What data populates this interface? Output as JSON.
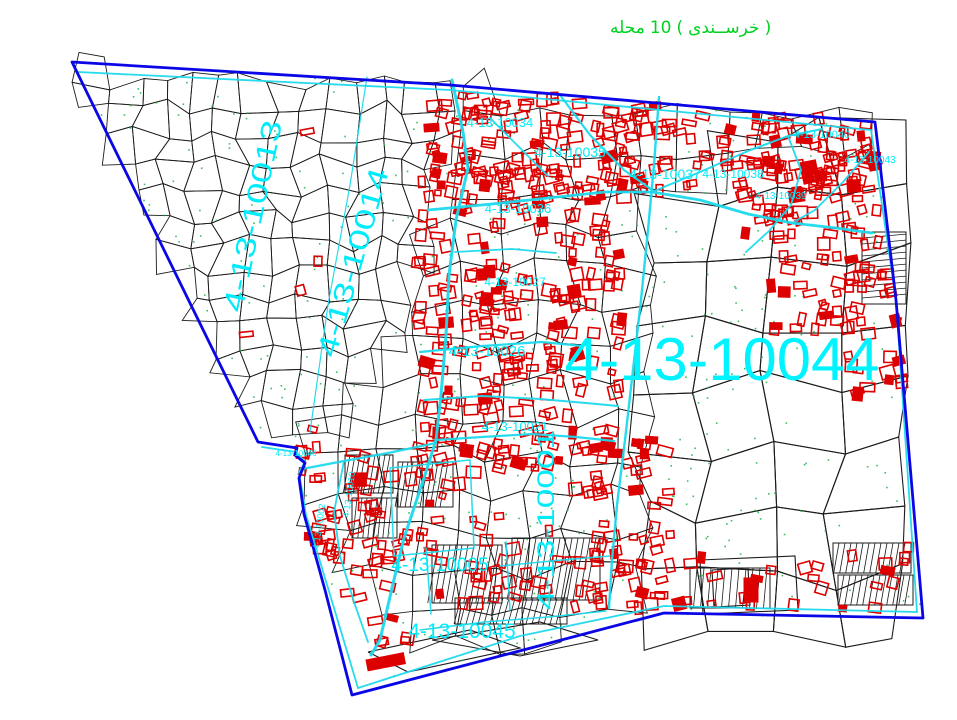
{
  "title": {
    "text": "محله 10 ( خرســندی )",
    "parts": [
      "محله",
      "10",
      "(",
      "خرســندی",
      ")"
    ],
    "color": "#00d221"
  },
  "map": {
    "seed": 7,
    "background": "#ffffff",
    "colors": {
      "boundary": "#0a06e6",
      "road": "#1bd9ec",
      "label": "#00ecfb",
      "big_label": "#00f4ff",
      "parcel": "#1c1c1c",
      "building": "#dd0000",
      "dot": "#1ab34a"
    },
    "boundary": [
      [
        72,
        62
      ],
      [
        450,
        85
      ],
      [
        875,
        122
      ],
      [
        896,
        300
      ],
      [
        923,
        618
      ],
      [
        664,
        613
      ],
      [
        352,
        695
      ],
      [
        325,
        590
      ],
      [
        304,
        514
      ],
      [
        299,
        478
      ],
      [
        305,
        463
      ],
      [
        295,
        455
      ],
      [
        297,
        448
      ],
      [
        258,
        442
      ]
    ],
    "fabric_zones": [
      {
        "name": "northwest-organic",
        "spacing": 27,
        "jitter": 9,
        "stroke_w": 0.9,
        "poly": [
          [
            78,
            68
          ],
          [
            455,
            88
          ],
          [
            440,
            200
          ],
          [
            400,
            335
          ],
          [
            335,
            432
          ],
          [
            264,
            442
          ]
        ]
      },
      {
        "name": "east-large-parcels",
        "spacing": 64,
        "jitter": 15,
        "stroke_w": 1.1,
        "poly": [
          [
            655,
            192
          ],
          [
            876,
            126
          ],
          [
            920,
            614
          ],
          [
            660,
            610
          ]
        ]
      },
      {
        "name": "central-mixed",
        "spacing": 38,
        "jitter": 11,
        "stroke_w": 0.9,
        "poly": [
          [
            430,
            86
          ],
          [
            875,
            122
          ],
          [
            920,
            612
          ],
          [
            664,
            610
          ],
          [
            424,
            652
          ],
          [
            332,
            562
          ],
          [
            300,
            470
          ],
          [
            302,
            432
          ],
          [
            400,
            332
          ],
          [
            442,
            200
          ]
        ],
        "exclude": [
          0,
          1
        ]
      }
    ],
    "extra_black_polys": [
      [
        [
          368,
          652
        ],
        [
          470,
          630
        ],
        [
          520,
          648
        ],
        [
          408,
          672
        ],
        [
          368,
          652
        ]
      ],
      [
        [
          432,
          640
        ],
        [
          540,
          622
        ],
        [
          598,
          640
        ],
        [
          520,
          656
        ],
        [
          432,
          640
        ]
      ],
      [
        [
          700,
          560
        ],
        [
          795,
          556
        ],
        [
          798,
          610
        ],
        [
          703,
          614
        ],
        [
          700,
          560
        ]
      ],
      [
        [
          712,
          570
        ],
        [
          748,
          568
        ],
        [
          750,
          605
        ],
        [
          714,
          607
        ],
        [
          712,
          570
        ]
      ]
    ],
    "hatch_blocks": [
      {
        "x": 345,
        "y": 455,
        "w": 48,
        "h": 38,
        "angle": 100,
        "step": 5
      },
      {
        "x": 352,
        "y": 498,
        "w": 45,
        "h": 40,
        "angle": 96,
        "step": 5
      },
      {
        "x": 398,
        "y": 462,
        "w": 55,
        "h": 45,
        "angle": 100,
        "step": 5
      },
      {
        "x": 432,
        "y": 545,
        "w": 70,
        "h": 58,
        "angle": 100,
        "step": 6
      },
      {
        "x": 512,
        "y": 538,
        "w": 88,
        "h": 62,
        "angle": 100,
        "step": 6
      },
      {
        "x": 455,
        "y": 598,
        "w": 112,
        "h": 26,
        "angle": 105,
        "step": 6
      },
      {
        "x": 862,
        "y": 232,
        "w": 44,
        "h": 72,
        "angle": 5,
        "step": 6
      },
      {
        "x": 833,
        "y": 543,
        "w": 78,
        "h": 30,
        "angle": 100,
        "step": 6
      },
      {
        "x": 838,
        "y": 575,
        "w": 75,
        "h": 30,
        "angle": 100,
        "step": 6
      },
      {
        "x": 690,
        "y": 568,
        "w": 80,
        "h": 40,
        "angle": 95,
        "step": 7
      }
    ],
    "roads": [
      {
        "w": 1.8,
        "pts": [
          [
            78,
            72
          ],
          [
            450,
            90
          ],
          [
            871,
            130
          ]
        ]
      },
      {
        "w": 1.8,
        "pts": [
          [
            871,
            130
          ],
          [
            896,
            300
          ],
          [
            917,
            612
          ]
        ]
      },
      {
        "w": 1.8,
        "pts": [
          [
            917,
            612
          ],
          [
            664,
            606
          ],
          [
            520,
            636
          ],
          [
            358,
            688
          ]
        ]
      },
      {
        "w": 1.8,
        "pts": [
          [
            358,
            688
          ],
          [
            328,
            588
          ],
          [
            306,
            515
          ],
          [
            299,
            472
          ],
          [
            305,
            462
          ],
          [
            296,
            452
          ],
          [
            262,
            447
          ]
        ]
      },
      {
        "w": 1.2,
        "pts": [
          [
            367,
            77
          ],
          [
            350,
            185
          ],
          [
            328,
            305
          ],
          [
            310,
            432
          ]
        ]
      },
      {
        "w": 3,
        "pts": [
          [
            452,
            80
          ],
          [
            463,
            132
          ],
          [
            468,
            168
          ],
          [
            456,
            220
          ],
          [
            449,
            275
          ],
          [
            446,
            335
          ],
          [
            441,
            395
          ],
          [
            436,
            440
          ],
          [
            424,
            478
          ],
          [
            404,
            538
          ],
          [
            392,
            588
          ],
          [
            380,
            640
          ],
          [
            371,
            655
          ]
        ]
      },
      {
        "w": 2.4,
        "pts": [
          [
            659,
            97
          ],
          [
            654,
            165
          ],
          [
            648,
            230
          ],
          [
            641,
            300
          ],
          [
            633,
            370
          ],
          [
            625,
            440
          ],
          [
            617,
            505
          ],
          [
            612,
            560
          ],
          [
            609,
            608
          ]
        ]
      },
      {
        "w": 2.8,
        "pts": [
          [
            428,
            210
          ],
          [
            492,
            204
          ],
          [
            548,
            198
          ],
          [
            605,
            192
          ],
          [
            652,
            192
          ],
          [
            700,
            200
          ],
          [
            748,
            214
          ],
          [
            792,
            223
          ],
          [
            836,
            228
          ],
          [
            872,
            233
          ]
        ]
      },
      {
        "w": 2.2,
        "pts": [
          [
            560,
            95
          ],
          [
            590,
            135
          ],
          [
            624,
            170
          ],
          [
            655,
            192
          ]
        ]
      },
      {
        "w": 2,
        "pts": [
          [
            652,
            192
          ],
          [
            700,
            172
          ],
          [
            748,
            151
          ],
          [
            788,
            136
          ],
          [
            822,
            129
          ]
        ]
      },
      {
        "w": 1.8,
        "pts": [
          [
            788,
            136
          ],
          [
            801,
            170
          ],
          [
            791,
            205
          ],
          [
            769,
            231
          ],
          [
            746,
            252
          ]
        ]
      },
      {
        "w": 1.8,
        "pts": [
          [
            869,
            152
          ],
          [
            843,
            182
          ],
          [
            815,
            210
          ],
          [
            792,
            223
          ]
        ]
      },
      {
        "w": 2.2,
        "pts": [
          [
            420,
            352
          ],
          [
            482,
            346
          ],
          [
            542,
            342
          ],
          [
            582,
            346
          ]
        ]
      },
      {
        "w": 2,
        "pts": [
          [
            424,
            400
          ],
          [
            482,
            396
          ],
          [
            540,
            399
          ],
          [
            586,
            403
          ],
          [
            618,
            406
          ]
        ]
      },
      {
        "w": 1.8,
        "pts": [
          [
            455,
            252
          ],
          [
            512,
            249
          ],
          [
            556,
            253
          ]
        ]
      },
      {
        "w": 2.2,
        "pts": [
          [
            436,
            440
          ],
          [
            482,
            437
          ],
          [
            532,
            434
          ],
          [
            576,
            437
          ],
          [
            614,
            441
          ]
        ]
      },
      {
        "w": 2.2,
        "pts": [
          [
            436,
            443
          ],
          [
            388,
            453
          ],
          [
            344,
            461
          ],
          [
            302,
            469
          ]
        ]
      },
      {
        "w": 1.8,
        "pts": [
          [
            344,
            461
          ],
          [
            334,
            512
          ],
          [
            340,
            556
          ],
          [
            354,
            602
          ],
          [
            368,
            642
          ]
        ]
      },
      {
        "w": 1.5,
        "pts": [
          [
            390,
            468
          ],
          [
            470,
            460
          ],
          [
            474,
            548
          ],
          [
            394,
            556
          ],
          [
            390,
            468
          ]
        ]
      },
      {
        "w": 1.5,
        "pts": [
          [
            426,
            548
          ],
          [
            431,
            614
          ]
        ]
      },
      {
        "w": 1.5,
        "pts": [
          [
            506,
            542
          ],
          [
            510,
            610
          ]
        ]
      },
      {
        "w": 1.5,
        "pts": [
          [
            500,
            566
          ],
          [
            562,
            560
          ],
          [
            610,
            556
          ]
        ]
      },
      {
        "w": 1.8,
        "pts": [
          [
            490,
            118
          ],
          [
            522,
            150
          ],
          [
            548,
            176
          ]
        ]
      },
      {
        "w": 1.5,
        "pts": [
          [
            420,
            630
          ],
          [
            485,
            622
          ],
          [
            548,
            617
          ],
          [
            606,
            611
          ]
        ]
      }
    ],
    "building_clusters": [
      {
        "x": 418,
        "y": 165,
        "w": 205,
        "h": 300,
        "count": 240
      },
      {
        "x": 430,
        "y": 95,
        "w": 320,
        "h": 105,
        "count": 150
      },
      {
        "x": 742,
        "y": 112,
        "w": 135,
        "h": 125,
        "count": 115
      },
      {
        "x": 765,
        "y": 235,
        "w": 140,
        "h": 95,
        "count": 50
      },
      {
        "x": 845,
        "y": 320,
        "w": 65,
        "h": 75,
        "count": 15
      },
      {
        "x": 298,
        "y": 428,
        "w": 135,
        "h": 175,
        "count": 70
      },
      {
        "x": 428,
        "y": 438,
        "w": 185,
        "h": 170,
        "count": 60
      },
      {
        "x": 596,
        "y": 440,
        "w": 75,
        "h": 175,
        "count": 45
      },
      {
        "x": 640,
        "y": 555,
        "w": 230,
        "h": 55,
        "count": 22
      },
      {
        "x": 105,
        "y": 95,
        "w": 260,
        "h": 270,
        "count": 7
      },
      {
        "x": 360,
        "y": 612,
        "w": 60,
        "h": 40,
        "count": 6
      },
      {
        "x": 868,
        "y": 545,
        "w": 50,
        "h": 70,
        "count": 8
      }
    ],
    "special_buildings": [
      {
        "x": 366,
        "y": 660,
        "w": 38,
        "h": 11,
        "rot": -11
      },
      {
        "x": 744,
        "y": 578,
        "w": 14,
        "h": 24,
        "rot": 0
      }
    ],
    "green_dots": 430,
    "district_labels": [
      {
        "text": "4-13-10013",
        "x": 262,
        "y": 218,
        "size": 28,
        "rot": -78,
        "len": 195
      },
      {
        "text": "4-13-10014",
        "x": 362,
        "y": 265,
        "size": 28,
        "rot": -74,
        "len": 195
      },
      {
        "text": "4-13-10044",
        "x": 722,
        "y": 380,
        "size": 60,
        "rot": 0,
        "len": 315
      },
      {
        "text": "4-13-10034",
        "x": 500,
        "y": 127,
        "size": 13,
        "rot": 0
      },
      {
        "text": "4-13-10035",
        "x": 570,
        "y": 157,
        "size": 14,
        "rot": 0
      },
      {
        "text": "4-13-10036",
        "x": 518,
        "y": 213,
        "size": 13,
        "rot": 0
      },
      {
        "text": "4-13-10037",
        "x": 665,
        "y": 179,
        "size": 14,
        "rot": 0
      },
      {
        "text": "4-13-10038",
        "x": 733,
        "y": 178,
        "size": 12,
        "rot": 0
      },
      {
        "text": "4-13-10039",
        "x": 781,
        "y": 199,
        "size": 10,
        "rot": 0
      },
      {
        "text": "4-13-10040",
        "x": 822,
        "y": 138,
        "size": 11,
        "rot": 0
      },
      {
        "text": "4-13-10043",
        "x": 870,
        "y": 163,
        "size": 10,
        "rot": 0
      },
      {
        "text": "4-13-10027",
        "x": 515,
        "y": 286,
        "size": 12,
        "rot": 0
      },
      {
        "text": "4-13-10026",
        "x": 487,
        "y": 356,
        "size": 15,
        "rot": 0
      },
      {
        "text": "4-13-10021",
        "x": 515,
        "y": 431,
        "size": 13,
        "rot": 0
      },
      {
        "text": "4-13-10001",
        "x": 554,
        "y": 520,
        "size": 24,
        "rot": -90,
        "len": 180
      },
      {
        "text": "4-13-10005",
        "x": 440,
        "y": 571,
        "size": 19,
        "rot": 0
      },
      {
        "text": "4-13-10045",
        "x": 462,
        "y": 638,
        "size": 21,
        "rot": 0
      },
      {
        "text": "4-13-10046",
        "x": 296,
        "y": 456,
        "size": 8,
        "rot": 0
      },
      {
        "text": "4-13-10002",
        "x": 322,
        "y": 527,
        "size": 9,
        "rot": -82
      },
      {
        "text": "4-13-10010",
        "x": 352,
        "y": 495,
        "size": 9,
        "rot": -82
      }
    ]
  }
}
